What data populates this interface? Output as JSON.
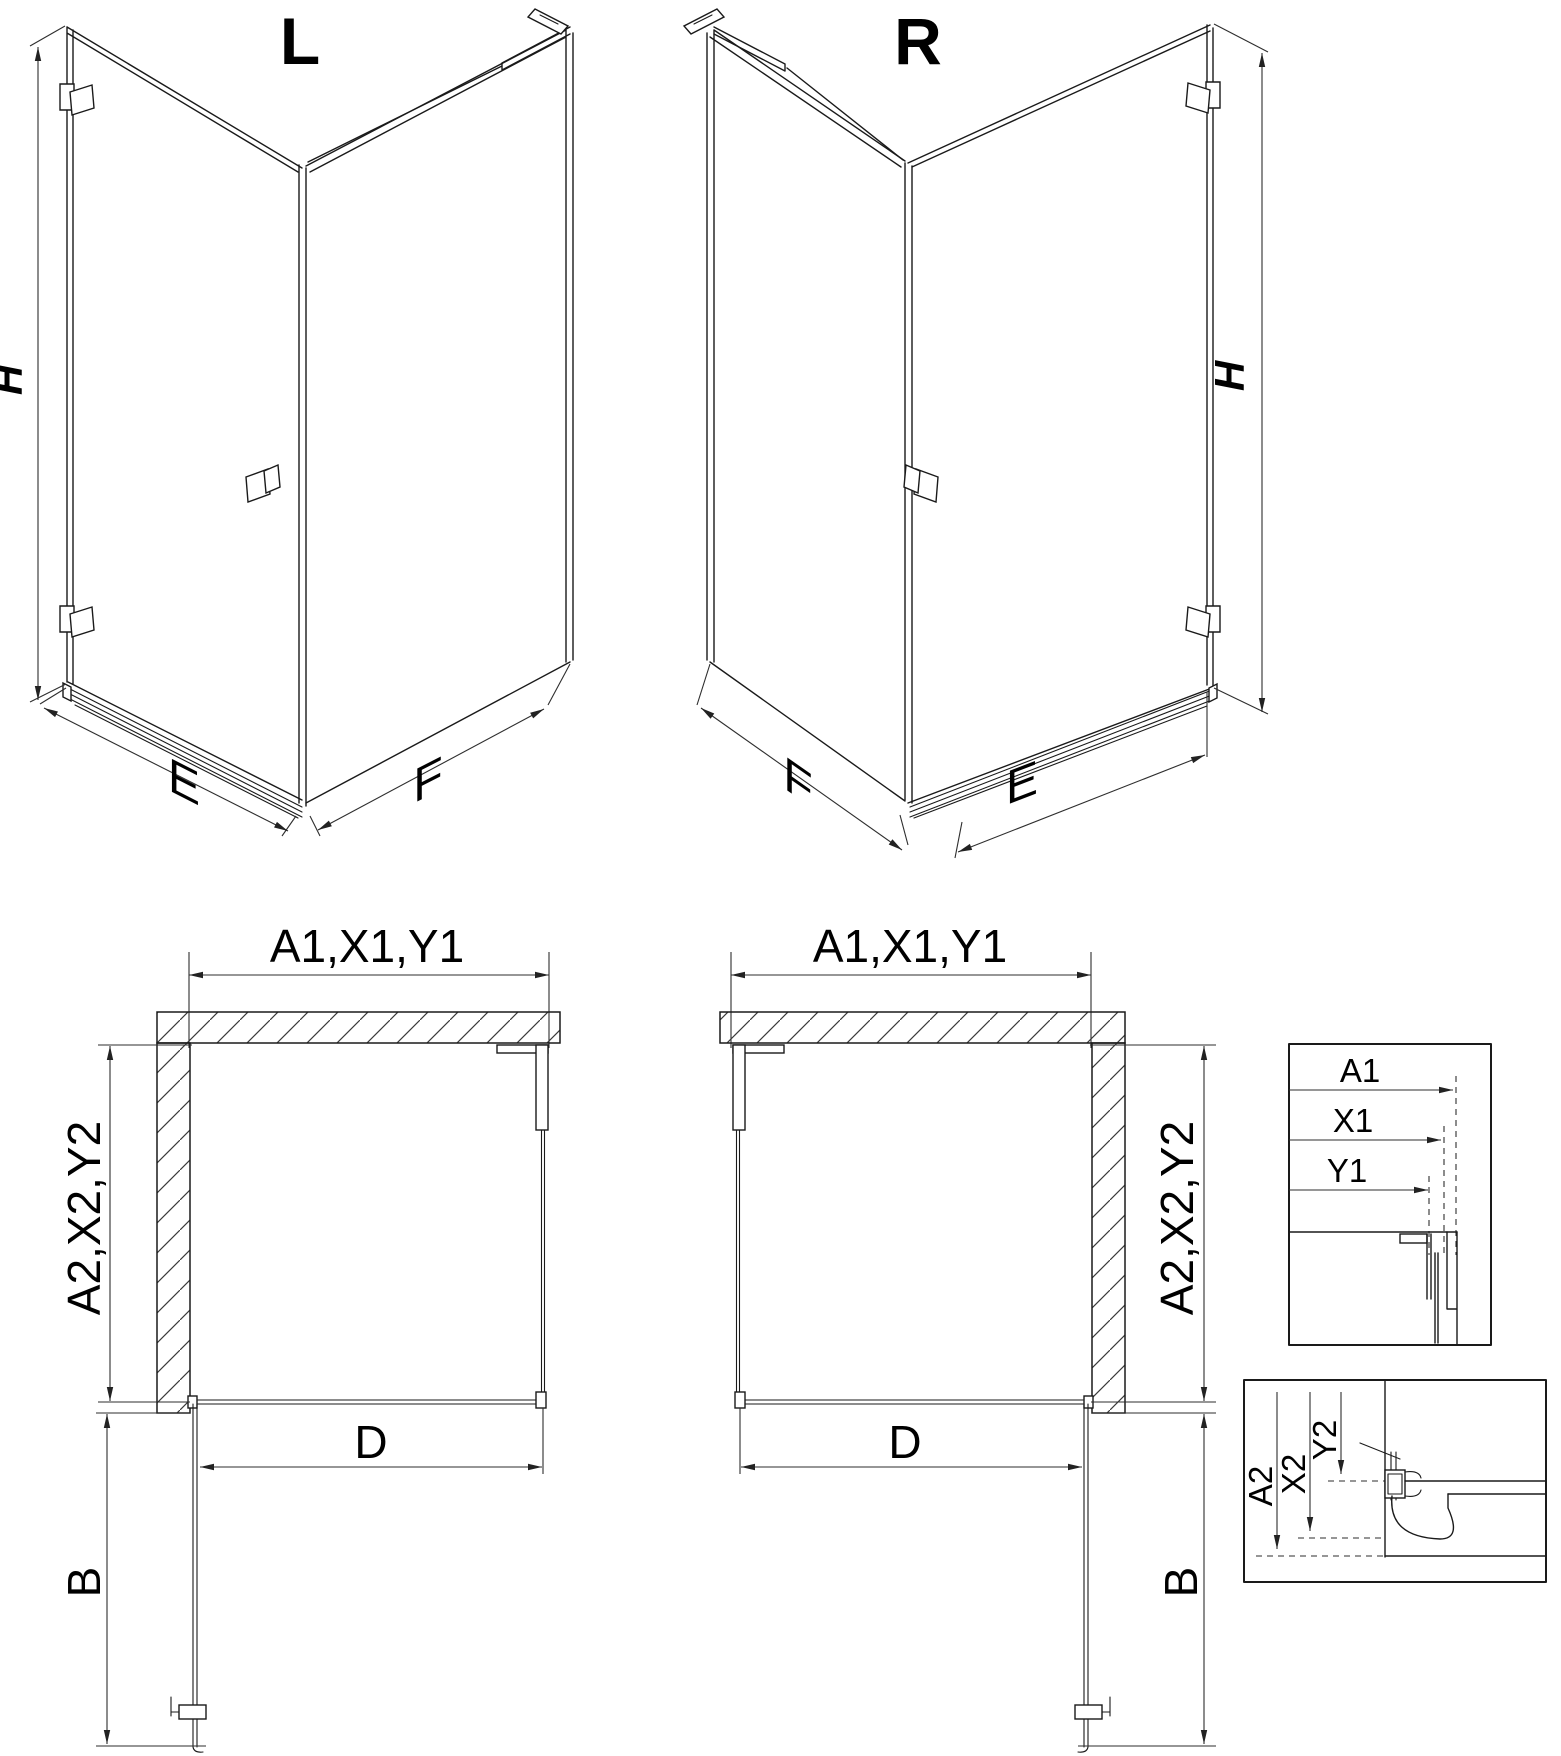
{
  "drawing": {
    "iso_left": {
      "title": "L",
      "height_label": "H",
      "door_width_label": "E",
      "panel_width_label": "F"
    },
    "iso_right": {
      "title": "R",
      "height_label": "H",
      "door_width_label": "E",
      "panel_width_label": "F"
    },
    "plan_left": {
      "width_label": "A1,X1,Y1",
      "depth_label": "A2,X2,Y2",
      "opening_label": "D",
      "swing_label": "B"
    },
    "plan_right": {
      "width_label": "A1,X1,Y1",
      "depth_label": "A2,X2,Y2",
      "opening_label": "D",
      "swing_label": "B"
    },
    "detail_horizontal": {
      "labels": [
        "A1",
        "X1",
        "Y1"
      ]
    },
    "detail_vertical": {
      "labels": [
        "A2",
        "X2",
        "Y2"
      ]
    }
  }
}
